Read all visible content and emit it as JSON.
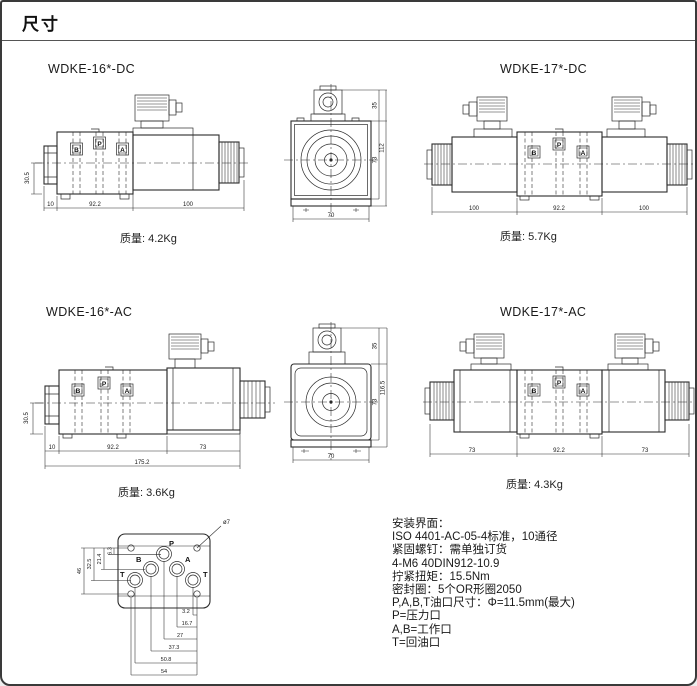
{
  "page": {
    "title": "尺寸"
  },
  "port_labels": {
    "p": "P",
    "a": "A",
    "b": "B",
    "t": "T"
  },
  "drawings": {
    "dc16": {
      "title": "WDKE-16*-DC",
      "weight": "质量: 4.2Kg",
      "dims": {
        "side_height": "30.5",
        "seg1": "10",
        "seg2": "92.2",
        "seg3": "100"
      }
    },
    "front_dc": {
      "dims": {
        "top": "35",
        "total": "112",
        "body": "73",
        "width": "70"
      }
    },
    "dc17": {
      "title": "WDKE-17*-DC",
      "weight": "质量: 5.7Kg",
      "dims": {
        "seg1": "100",
        "seg2": "92.2",
        "seg3": "100"
      }
    },
    "ac16": {
      "title": "WDKE-16*-AC",
      "weight": "质量: 3.6Kg",
      "dims": {
        "side_height": "30.5",
        "seg1": "10",
        "seg2": "92.2",
        "seg3": "73",
        "total": "175.2"
      }
    },
    "front_ac": {
      "dims": {
        "top": "35",
        "total": "116.5",
        "body": "73",
        "width": "70"
      }
    },
    "ac17": {
      "title": "WDKE-17*-AC",
      "weight": "质量: 4.3Kg",
      "dims": {
        "seg1": "73",
        "seg2": "92.2",
        "seg3": "73"
      }
    },
    "mounting": {
      "hole_callout": "ø7",
      "dims_vertical": {
        "v1": "6.3",
        "v2": "21.4",
        "v3": "32.5",
        "v4": "46"
      },
      "dims_horizontal": {
        "h1": "3.2",
        "h2": "16.7",
        "h3": "27",
        "h4": "37.3",
        "h5": "50.8",
        "h6": "54"
      }
    }
  },
  "notes": {
    "lines": [
      "安装界面：",
      "ISO 4401-AC-05-4标准，10通径",
      "紧固螺钉：需单独订货",
      "4-M6 40DIN912-10.9",
      "拧紧扭矩：15.5Nm",
      "密封圈：5个OR形圈2050",
      "P,A,B,T油口尺寸：Φ=11.5mm(最大)",
      "P=压力口",
      "A,B=工作口",
      "T=回油口"
    ]
  }
}
